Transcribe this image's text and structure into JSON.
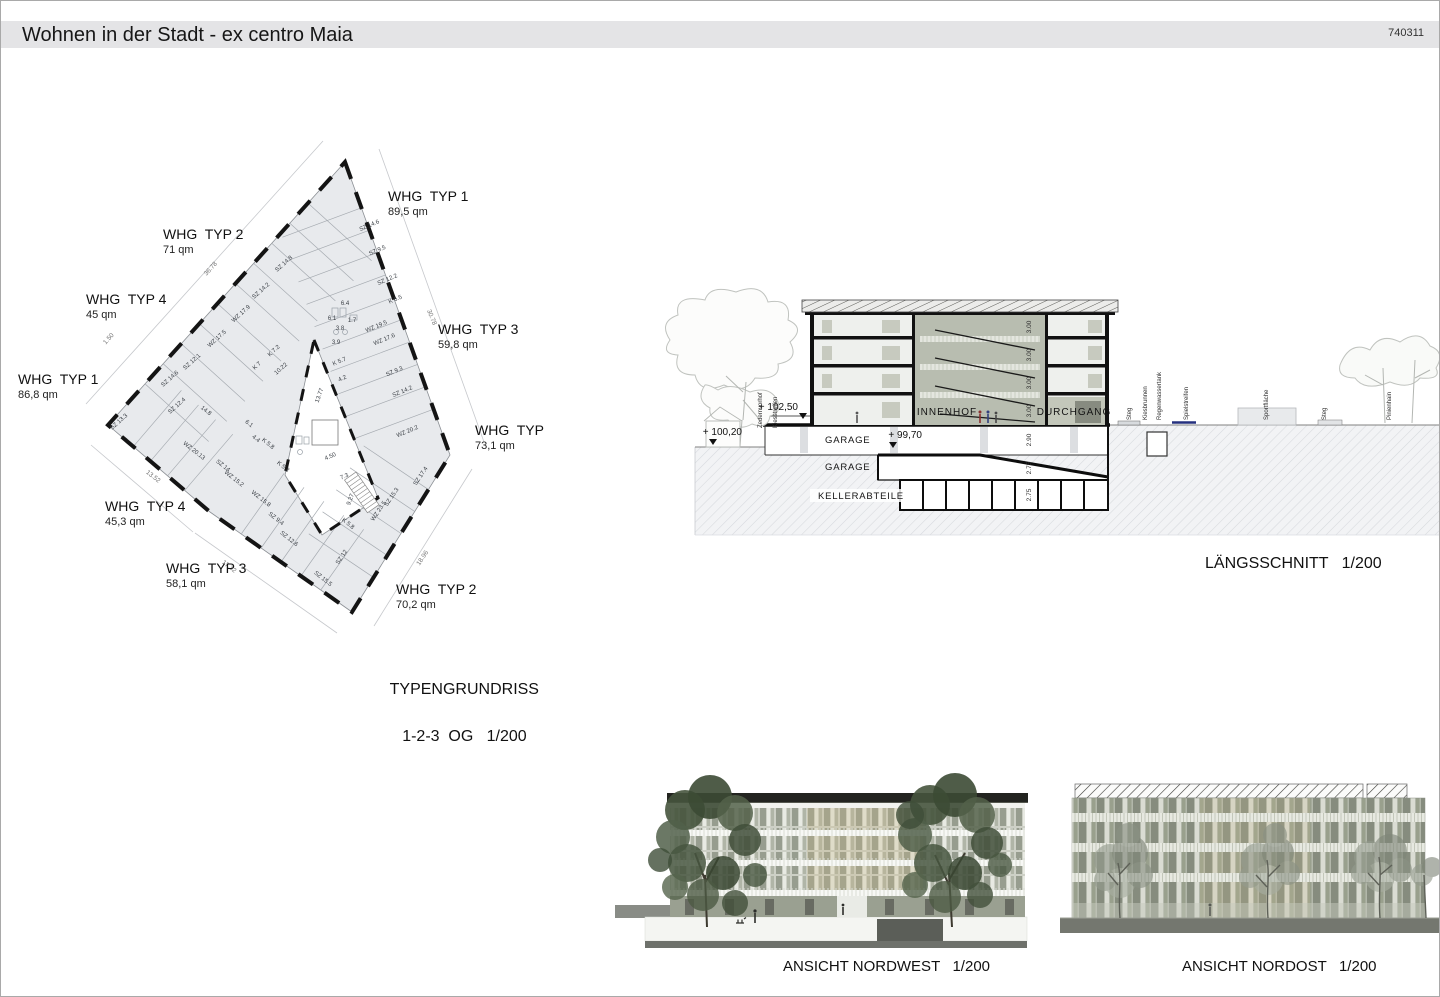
{
  "header": {
    "title": "Wohnen in der Stadt - ex centro Maia",
    "sheet_number": "740311"
  },
  "floor_plan": {
    "caption": {
      "line1": "TYPENGRUNDRISS",
      "line2": "1-2-3  OG   1/200"
    },
    "apartments": [
      {
        "name": "WHG  TYP 1",
        "area": "89,5 qm",
        "x": 388,
        "y": 188
      },
      {
        "name": "WHG  TYP 2",
        "area": "71 qm",
        "x": 163,
        "y": 226
      },
      {
        "name": "WHG  TYP 4",
        "area": "45 qm",
        "x": 86,
        "y": 291
      },
      {
        "name": "WHG  TYP 3",
        "area": "59,8 qm",
        "x": 438,
        "y": 321
      },
      {
        "name": "WHG  TYP 1",
        "area": "86,8 qm",
        "x": 18,
        "y": 371
      },
      {
        "name": "WHG  TYP",
        "area": "73,1 qm",
        "x": 475,
        "y": 422
      },
      {
        "name": "WHG  TYP 4",
        "area": "45,3 qm",
        "x": 105,
        "y": 498
      },
      {
        "name": "WHG  TYP 3",
        "area": "58,1 qm",
        "x": 166,
        "y": 560
      },
      {
        "name": "WHG  TYP 2",
        "area": "70,2 qm",
        "x": 396,
        "y": 581
      }
    ],
    "room_labels": [
      {
        "t": "SZ 14.6",
        "x": 320,
        "y": 87,
        "r": -23
      },
      {
        "t": "SZ 9.5",
        "x": 328,
        "y": 112,
        "r": -23
      },
      {
        "t": "SZ 12.2",
        "x": 338,
        "y": 141,
        "r": -23
      },
      {
        "t": "K 6.5",
        "x": 346,
        "y": 161,
        "r": -23
      },
      {
        "t": "WZ 19.5",
        "x": 327,
        "y": 188,
        "r": -23
      },
      {
        "t": "WZ 17.6",
        "x": 335,
        "y": 201,
        "r": -23
      },
      {
        "t": "K 5.7",
        "x": 290,
        "y": 223,
        "r": -23
      },
      {
        "t": "4.2",
        "x": 293,
        "y": 240,
        "r": -23
      },
      {
        "t": "SZ 9.3",
        "x": 345,
        "y": 233,
        "r": -23
      },
      {
        "t": "SZ 14.2",
        "x": 353,
        "y": 253,
        "r": -23
      },
      {
        "t": "WZ 20.2",
        "x": 358,
        "y": 293,
        "r": -23
      },
      {
        "t": "SZ 17.4",
        "x": 372,
        "y": 337,
        "r": -56
      },
      {
        "t": "SZ 15.3",
        "x": 343,
        "y": 358,
        "r": -56
      },
      {
        "t": "WZ 23.5",
        "x": 330,
        "y": 372,
        "r": -56
      },
      {
        "t": "K 5.8",
        "x": 297,
        "y": 385,
        "r": 38
      },
      {
        "t": "SZ 12",
        "x": 293,
        "y": 418,
        "r": -56
      },
      {
        "t": "SZ 15.5",
        "x": 272,
        "y": 440,
        "r": 38
      },
      {
        "t": "SZ 14.8",
        "x": 235,
        "y": 125,
        "r": -42
      },
      {
        "t": "SZ 14.2",
        "x": 212,
        "y": 152,
        "r": -42
      },
      {
        "t": "WZ 17.9",
        "x": 192,
        "y": 175,
        "r": -42
      },
      {
        "t": "WZ 17.5",
        "x": 168,
        "y": 200,
        "r": -42
      },
      {
        "t": "SZ 12.1",
        "x": 143,
        "y": 223,
        "r": -42
      },
      {
        "t": "SZ 14.6",
        "x": 121,
        "y": 240,
        "r": -42
      },
      {
        "t": "SZ 12.4",
        "x": 128,
        "y": 267,
        "r": -42
      },
      {
        "t": "SZ 13.3",
        "x": 70,
        "y": 283,
        "r": -42
      },
      {
        "t": "K 7.2",
        "x": 225,
        "y": 212,
        "r": -42
      },
      {
        "t": "K 7",
        "x": 208,
        "y": 227,
        "r": -42
      },
      {
        "t": "14.8",
        "x": 155,
        "y": 272,
        "r": 38
      },
      {
        "t": "WZ 20.13",
        "x": 143,
        "y": 312,
        "r": 38
      },
      {
        "t": "SZ 14",
        "x": 172,
        "y": 327,
        "r": 38
      },
      {
        "t": "WZ 15.2",
        "x": 183,
        "y": 340,
        "r": 38
      },
      {
        "t": "WZ 15.8",
        "x": 210,
        "y": 360,
        "r": 38
      },
      {
        "t": "SZ 9.4",
        "x": 225,
        "y": 380,
        "r": 38
      },
      {
        "t": "SZ 12.6",
        "x": 238,
        "y": 400,
        "r": 38
      },
      {
        "t": "K 5.2",
        "x": 232,
        "y": 328,
        "r": 38
      },
      {
        "t": "K 5.8",
        "x": 217,
        "y": 305,
        "r": 38
      },
      {
        "t": "6.1",
        "x": 198,
        "y": 285,
        "r": 38
      },
      {
        "t": "4.4",
        "x": 205,
        "y": 300,
        "r": 38
      },
      {
        "t": "6.4",
        "x": 295,
        "y": 165,
        "r": 0
      },
      {
        "t": "6.1",
        "x": 282,
        "y": 180,
        "r": 0
      },
      {
        "t": "1.7",
        "x": 302,
        "y": 182,
        "r": 0
      },
      {
        "t": "3.8",
        "x": 290,
        "y": 190,
        "r": 0
      },
      {
        "t": "3.9",
        "x": 286,
        "y": 204,
        "r": 0
      },
      {
        "t": "7.3",
        "x": 295,
        "y": 338,
        "r": -23
      },
      {
        "t": "9.27",
        "x": 302,
        "y": 360,
        "r": -70
      },
      {
        "t": "13.77",
        "x": 271,
        "y": 256,
        "r": -70
      },
      {
        "t": "10.22",
        "x": 232,
        "y": 230,
        "r": -42
      },
      {
        "t": "4.50",
        "x": 281,
        "y": 318,
        "r": -23
      }
    ],
    "dim_labels": [
      {
        "t": "36.78",
        "x": 162,
        "y": 130,
        "r": -48
      },
      {
        "t": "30.78",
        "x": 380,
        "y": 178,
        "r": 68
      },
      {
        "t": "13.52",
        "x": 102,
        "y": 338,
        "r": 38
      },
      {
        "t": "17.32",
        "x": 178,
        "y": 428,
        "r": 38
      },
      {
        "t": "18.96",
        "x": 374,
        "y": 419,
        "r": -56
      },
      {
        "t": "1.50",
        "x": 60,
        "y": 200,
        "r": -48
      }
    ]
  },
  "section": {
    "caption": "LÄNGSSCHNITT   1/200",
    "zone_labels": [
      {
        "t": "INNENHOF",
        "x": 297,
        "y": 135
      },
      {
        "t": "DURCHGANG",
        "x": 424,
        "y": 135
      }
    ],
    "structure_labels": [
      {
        "t": "GARAGE",
        "x": 175,
        "y": 163
      },
      {
        "t": "GARAGE",
        "x": 175,
        "y": 190
      },
      {
        "t": "KELLERABTEILE",
        "x": 168,
        "y": 219
      }
    ],
    "levels": [
      {
        "t": "+ 102,50",
        "x": 148,
        "y": 130,
        "mx": 153,
        "my": 133
      },
      {
        "t": "+ 100,20",
        "x": 92,
        "y": 155,
        "mx": 63,
        "my": 159
      },
      {
        "t": "+ 99,70",
        "x": 272,
        "y": 158,
        "mx": 243,
        "my": 162
      }
    ],
    "floor_heights": [
      {
        "t": "3.00",
        "x": 381,
        "y": 47
      },
      {
        "t": "3.00",
        "x": 381,
        "y": 75
      },
      {
        "t": "3.00",
        "x": 381,
        "y": 103
      },
      {
        "t": "3.00",
        "x": 381,
        "y": 131
      },
      {
        "t": "2.90",
        "x": 381,
        "y": 160
      },
      {
        "t": "2.75",
        "x": 381,
        "y": 188
      },
      {
        "t": "2.75",
        "x": 381,
        "y": 215
      }
    ],
    "site_labels": [
      {
        "t": "Zedernvorhof",
        "x": 112,
        "y": 148
      },
      {
        "t": "Kiesstreifen",
        "x": 127,
        "y": 148
      },
      {
        "t": "Steg",
        "x": 481,
        "y": 140
      },
      {
        "t": "Kiesbrunnen",
        "x": 497,
        "y": 140
      },
      {
        "t": "Regenwassertank",
        "x": 511,
        "y": 140
      },
      {
        "t": "Spielstreifen",
        "x": 538,
        "y": 140
      },
      {
        "t": "Sportfläche",
        "x": 618,
        "y": 140
      },
      {
        "t": "Steg",
        "x": 676,
        "y": 140
      },
      {
        "t": "Pinienhain",
        "x": 741,
        "y": 140
      }
    ]
  },
  "elevations": {
    "northwest_caption": "ANSICHT NORDWEST   1/200",
    "northeast_caption": "ANSICHT NORDOST   1/200"
  }
}
